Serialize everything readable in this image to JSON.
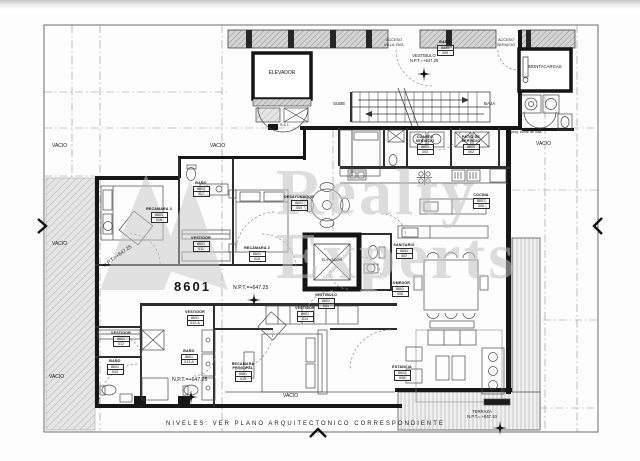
{
  "plan": {
    "unit_number": "8601",
    "note_niveles": "NIVELES: VER PLANO ARQUITECTONICO CORRESPONDIENTE",
    "watermark": {
      "word1": "Realty",
      "word2": "Experts"
    },
    "voids_label": "VACIO",
    "stairs": {
      "up": "SUBE",
      "down": "BAJA",
      "sci": "S.C.I."
    },
    "elevators": {
      "top": "ELEVADOR",
      "private": "ELEVADOR",
      "freight": "MONTACARGAS"
    },
    "accesses": {
      "villa": {
        "line1": "ACCESO",
        "line2": "VILLA 7601"
      },
      "servicio": {
        "line1": "ACCESO",
        "line2": "SERVICIO"
      }
    },
    "levels": {
      "vestibulo_title": "VESTIBULO",
      "vestibulo_npt": "N.P.T.=+647.25",
      "npt_main": "N.P.T.=+647.25",
      "npt_bedroom": "N.P.T.=+647.25",
      "npt_bottom": "N.P.T.=+647.25",
      "terraza_title": "TERRAZA",
      "terraza_npt": "N.P.T.= +647.10"
    },
    "annotations": {
      "proy": "proy. borde de losa"
    },
    "colors": {
      "line": "#444444",
      "wall": "#141414",
      "hatch": "#bdbdbd",
      "watermark": "#c2c2c2",
      "paper": "#fdfdfd"
    },
    "rooms": [
      {
        "name": "RECAMARA 3",
        "unit": "8601",
        "id": "016"
      },
      {
        "name": "BAÑO",
        "unit": "8601",
        "id": "017"
      },
      {
        "name": "VESTIDOR",
        "unit": "8601",
        "id": "011"
      },
      {
        "name": "RECAMARA 2",
        "unit": "8601",
        "id": "018"
      },
      {
        "name": "DESAYUNADOR",
        "unit": "8601",
        "id": "004"
      },
      {
        "name": "VESTIBULO",
        "unit": "8601",
        "id": "001"
      },
      {
        "name": "SANITARIO",
        "unit": "8601",
        "id": "007"
      },
      {
        "name": "COMEDOR",
        "unit": "8601",
        "id": "006"
      },
      {
        "name": "COCINA",
        "unit": "8601",
        "id": "005"
      },
      {
        "name": "CUARTO SERVICIO",
        "unit": "8601",
        "id": "003"
      },
      {
        "name": "PATIO DE SERVICIO",
        "unit": "8601",
        "id": "002"
      },
      {
        "name": "BAÑO",
        "unit": "8601",
        "id": "009"
      },
      {
        "name": "VESTIDOR",
        "unit": "8601",
        "id": "012"
      },
      {
        "name": "BAÑO",
        "unit": "8601",
        "id": "013"
      },
      {
        "name": "VESTIDOR",
        "unit": "8601",
        "id": "012-A"
      },
      {
        "name": "BAÑO",
        "unit": "8601",
        "id": "013-A"
      },
      {
        "name": "VESTIDOR",
        "unit": "8601",
        "id": "014"
      },
      {
        "name": "RECAMARA PRINCIPAL",
        "unit": "8601",
        "id": "015"
      },
      {
        "name": "ESTANCIA",
        "unit": "8601",
        "id": "008"
      }
    ]
  }
}
